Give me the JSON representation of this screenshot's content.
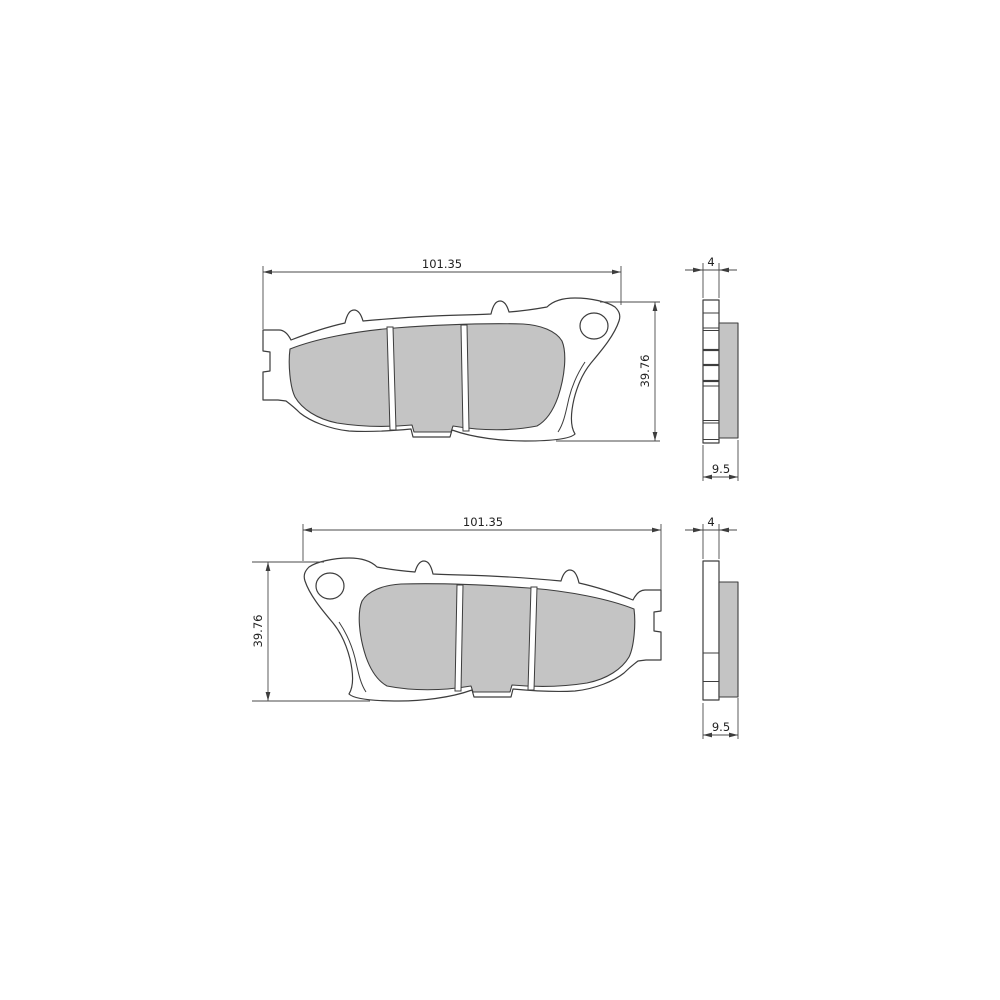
{
  "page": {
    "background": "#ffffff"
  },
  "drawing": {
    "type": "technical-drawing",
    "subject": "brake-pad-set-front-and-side-views",
    "colors": {
      "line": "#3d3d3d",
      "dim_line": "#4a4a4a",
      "friction_fill": "#c4c4c4",
      "text": "#222222",
      "background": "#ffffff"
    },
    "top_pad": {
      "width": "101.35",
      "height": "39.76",
      "plate_thickness": "4",
      "total_thickness": "9.5"
    },
    "bottom_pad": {
      "width": "101.35",
      "height": "39.76",
      "plate_thickness": "4",
      "total_thickness": "9.5"
    }
  }
}
